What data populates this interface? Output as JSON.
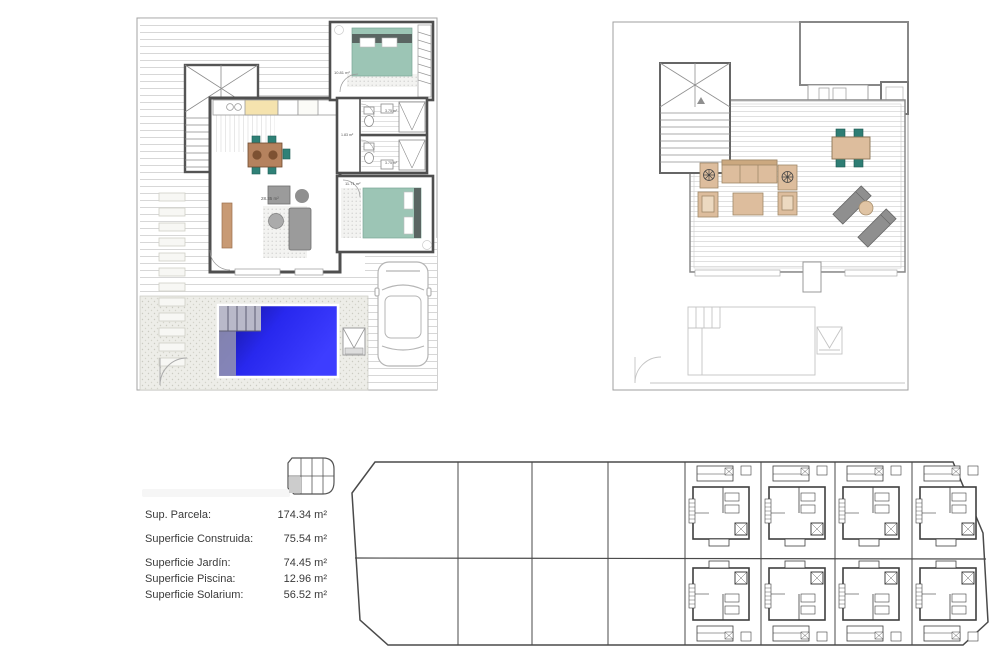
{
  "document": {
    "type": "architectural-plan-sheet",
    "background": "#ffffff"
  },
  "ground_floor_plan": {
    "room_labels": {
      "living_kitchen": "28.35 m²",
      "bedroom_main": "10.81 m²",
      "hallway": "1.83 m²",
      "bathroom_1": "3.75 m²",
      "bathroom_2": "3.75 m²",
      "bedroom_second": "11.71 m²"
    }
  },
  "areas_panel": {
    "rows": [
      {
        "label": "Sup. Parcela:",
        "value": "174.34 m²"
      },
      {
        "label": "Superficie Construida:",
        "value": "75.54 m²"
      },
      {
        "label": "Superficie Jardín:",
        "value": "74.45 m²"
      },
      {
        "label": "Superficie Piscina:",
        "value": "12.96 m²"
      },
      {
        "label": "Superficie Solarium:",
        "value": "56.52 m²"
      }
    ]
  },
  "palette": {
    "pool_blue": "#2b2bf0",
    "pool_dark": "#10104f",
    "bed_teal": "#9cc5b5",
    "chair_teal": "#2f8177",
    "dining_wood": "#b5825e",
    "terrace_tan": "#ddbd9d",
    "lounger_gray": "#8f8f8f",
    "wall_gray": "#4f4f4f",
    "faint_line": "#c4c4c4"
  }
}
